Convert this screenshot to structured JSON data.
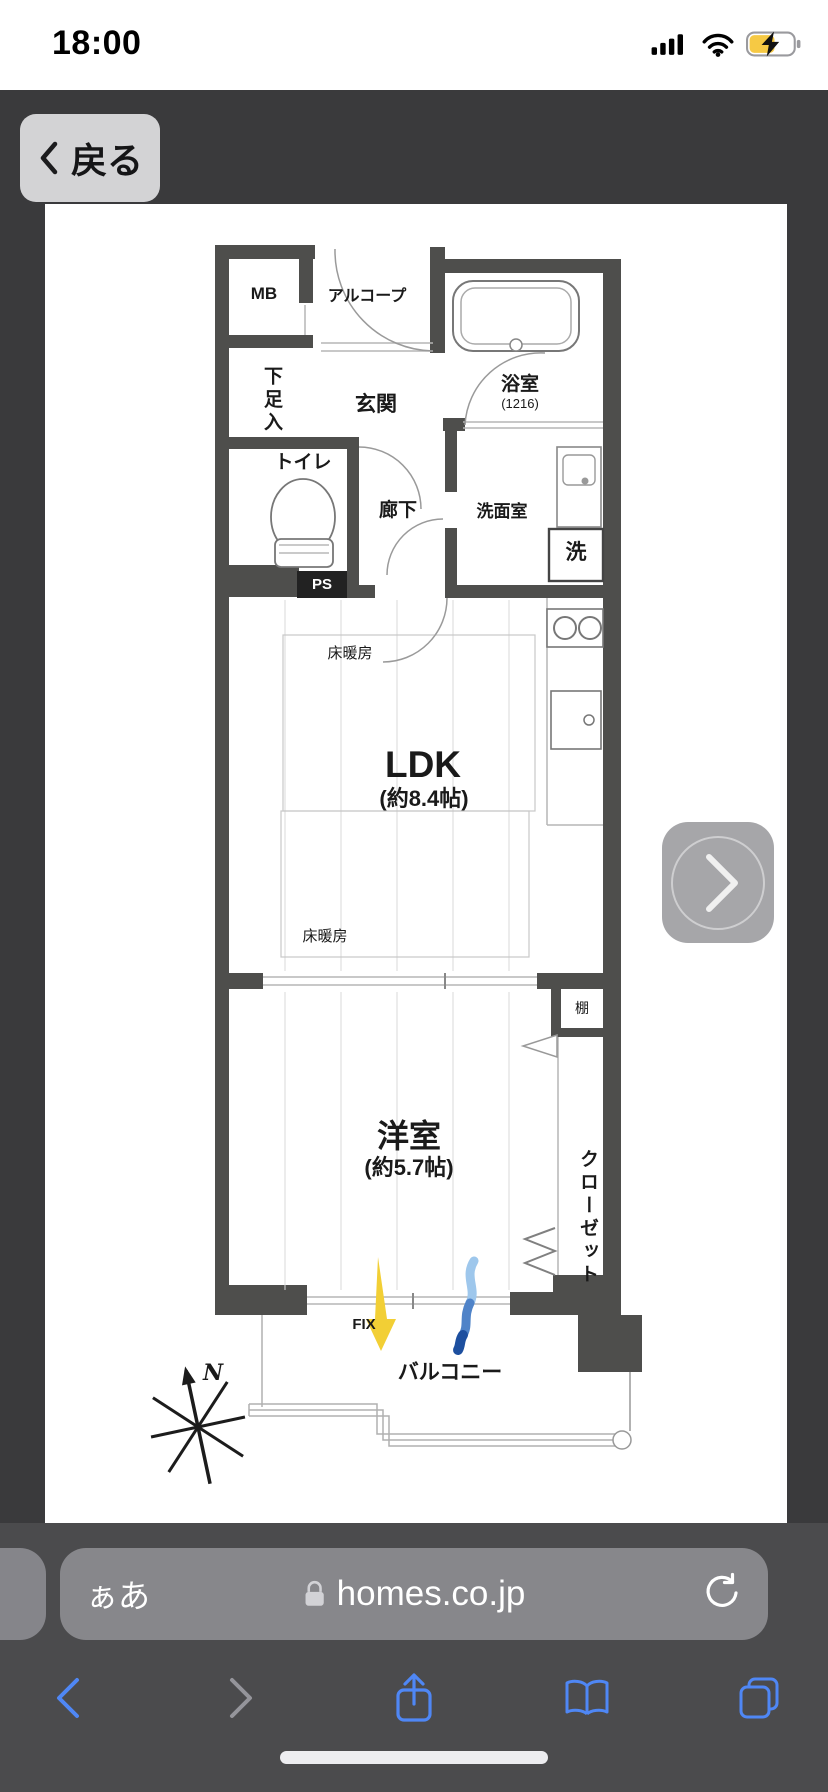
{
  "status_bar": {
    "time": "18:00",
    "signal_icon": "cellular-signal-bars",
    "wifi_icon": "wifi",
    "battery_icon": "battery-charging",
    "battery_fill_color": "#f6c944"
  },
  "top_nav": {
    "back_label": "戻る",
    "back_icon": "chevron-left"
  },
  "floor_plan": {
    "labels": {
      "mb": "MB",
      "alcove": "アルコープ",
      "shoe_cabinet": "下足入",
      "entrance": "玄関",
      "bathroom": "浴室",
      "bathroom_size": "(1216)",
      "toilet": "トイレ",
      "hallway": "廊下",
      "washroom": "洗面室",
      "washer": "洗",
      "pipe_space": "PS",
      "floor_heating_upper": "床暖房",
      "floor_heating_lower": "床暖房",
      "ldk": "LDK",
      "ldk_size": "(約8.4帖)",
      "western_room": "洋室",
      "western_room_size": "(約5.7帖)",
      "shelf": "棚",
      "closet": "クローゼット",
      "fix_window": "FIX",
      "balcony": "バルコニー",
      "compass_north": "N"
    },
    "wall_color": "#4e4e4c",
    "fix_arrow_color": "#f2cf35",
    "airflow_arrow_color": "#2456a8"
  },
  "image_pager": {
    "next_icon": "chevron-right"
  },
  "address_bar": {
    "reader_button": "ぁあ",
    "lock_icon": "lock",
    "url": "homes.co.jp",
    "reload_icon": "reload"
  },
  "bottom_toolbar": {
    "back_icon": "chevron-left",
    "forward_icon": "chevron-right",
    "share_icon": "share",
    "bookmarks_icon": "book-open",
    "tabs_icon": "stacked-squares",
    "accent_color": "#4f87f5"
  }
}
